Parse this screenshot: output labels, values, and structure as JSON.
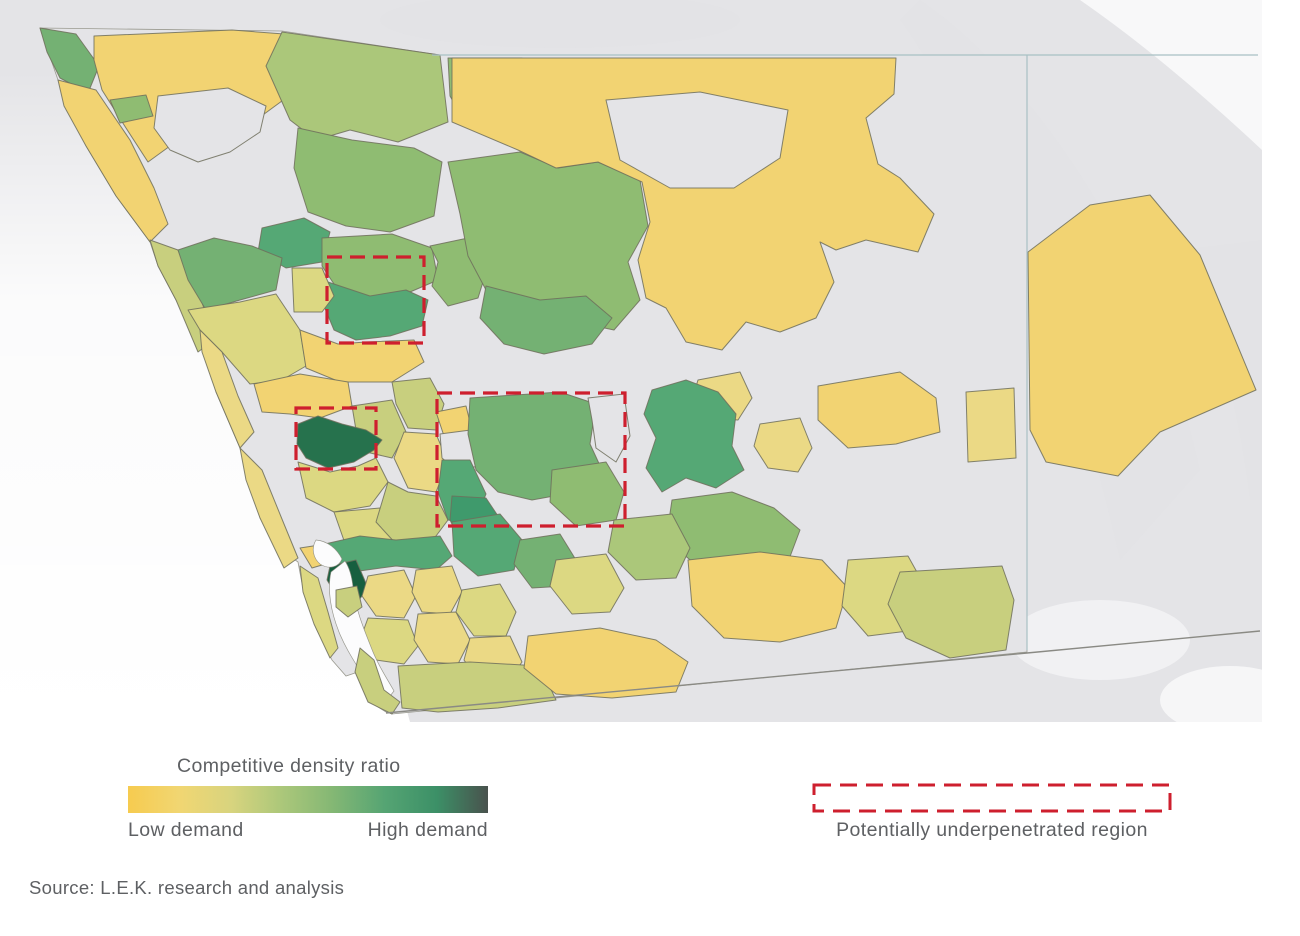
{
  "legend": {
    "title": "Competitive density ratio",
    "low_label": "Low demand",
    "high_label": "High demand",
    "underpenetrated_label": "Potentially underpenetrated region",
    "gradient": [
      "#F6CB4F",
      "#F1D672",
      "#D8D47E",
      "#ABC77A",
      "#83B774",
      "#55A473",
      "#3C9067",
      "#49524D"
    ]
  },
  "source": {
    "text": "Source: L.E.K. research and analysis"
  },
  "map": {
    "background": "#EDEDEF",
    "ocean": "#FFFFFF",
    "stroke": "#6E6E5C",
    "county_line_color": "#A8C0C4",
    "border_line_color": "#8A8A84",
    "highlight_color": "#CE1F2E",
    "palette": {
      "y1": "#F2D372",
      "y2": "#EBD985",
      "ol": "#DCD882",
      "lg": "#C8CF7E",
      "g1": "#ABC77A",
      "g2": "#8FBC72",
      "g3": "#74B173",
      "g4": "#55A875",
      "g5": "#3F9A6C",
      "dg": "#26724D",
      "dg2": "#175F3F",
      "nd": "#E4E4E7",
      "terrain": "#E2E2E5",
      "highlight_white": "#FAFAFB",
      "bay": "#FCFCFD"
    }
  }
}
